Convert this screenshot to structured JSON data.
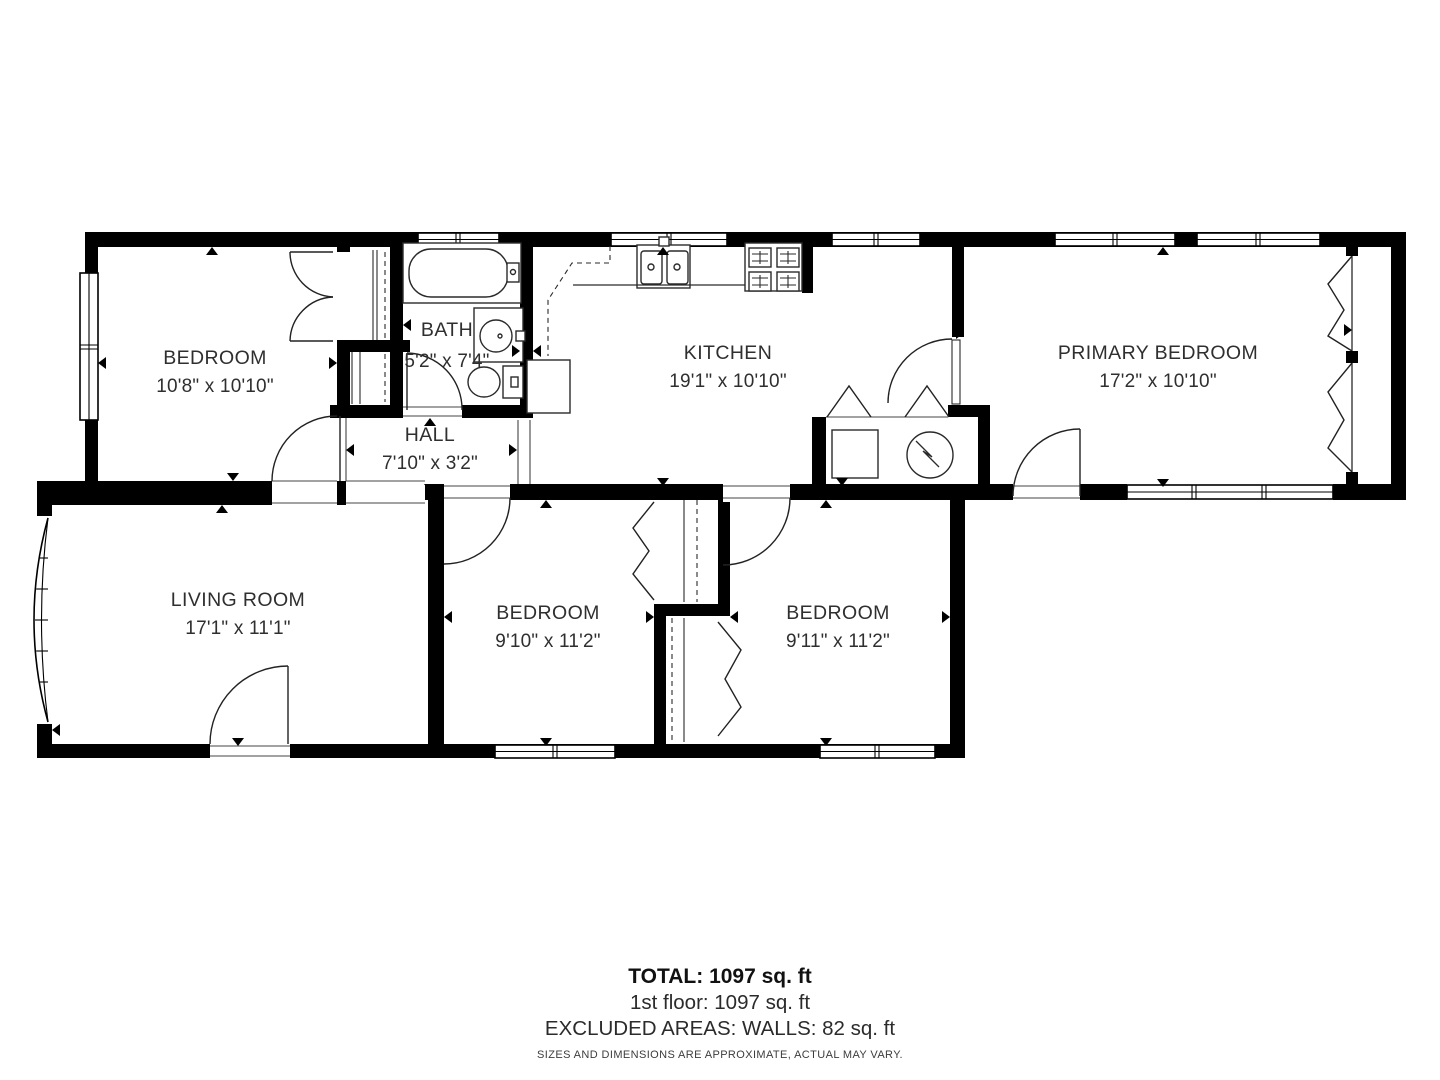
{
  "plan": {
    "rooms": [
      {
        "id": "bedroom-top-left",
        "name": "BEDROOM",
        "dimensions": "10'8\" x 10'10\""
      },
      {
        "id": "bath",
        "name": "BATH",
        "dimensions": "5'2\" x 7'4\""
      },
      {
        "id": "kitchen",
        "name": "KITCHEN",
        "dimensions": "19'1\" x 10'10\""
      },
      {
        "id": "primary-bedroom",
        "name": "PRIMARY BEDROOM",
        "dimensions": "17'2\" x 10'10\""
      },
      {
        "id": "hall",
        "name": "HALL",
        "dimensions": "7'10\" x 3'2\""
      },
      {
        "id": "living-room",
        "name": "LIVING ROOM",
        "dimensions": "17'1\" x 11'1\""
      },
      {
        "id": "bedroom-bottom-middle",
        "name": "BEDROOM",
        "dimensions": "9'10\" x 11'2\""
      },
      {
        "id": "bedroom-bottom-right",
        "name": "BEDROOM",
        "dimensions": "9'11\" x 11'2\""
      }
    ],
    "fixtures": [
      "bathtub",
      "vanity-sink",
      "toilet",
      "kitchen-sink",
      "stove",
      "washer",
      "dryer",
      "bow-window"
    ]
  },
  "summary": {
    "total": "TOTAL: 1097 sq. ft",
    "floor_1": "1st floor: 1097 sq. ft",
    "excluded": "EXCLUDED AREAS: WALLS: 82 sq. ft",
    "disclaimer": "SIZES AND DIMENSIONS ARE APPROXIMATE, ACTUAL MAY VARY."
  },
  "colors": {
    "wall": "#000000",
    "fixture_line": "#2a2a2a",
    "label_text": "#2f2f2f",
    "background": "#ffffff"
  }
}
